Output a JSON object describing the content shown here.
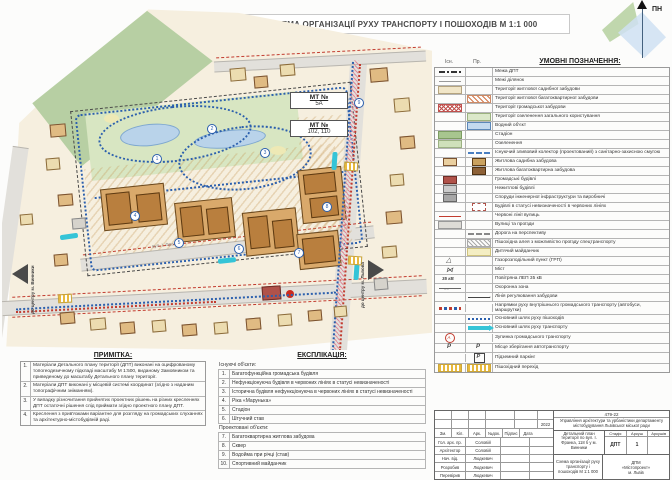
{
  "title": "СХЕМА ОРГАНІЗАЦІЇ РУХУ ТРАНСПОРТУ І ПОШОХОДІВ М 1:1 000",
  "north_label": "ПН",
  "map": {
    "mt1_title": "МТ №",
    "mt1_value": "5А",
    "mt2_title": "МТ №",
    "mt2_value": "102, 110",
    "street_label": "вул. І. Франка",
    "arrow_left_label": "до центру м. Винники",
    "arrow_right_label": "до центру м. Львова",
    "path_numbers": [
      "1",
      "2",
      "3",
      "4",
      "5",
      "6",
      "7",
      "8",
      "9"
    ]
  },
  "legend": {
    "header": "УМОВНІ ПОЗНАЧЕННЯ:",
    "col_exist": "Існ.",
    "col_proj": "Пр.",
    "rows": [
      {
        "label": "Межа ДПТ",
        "ex": "ln-dashdot"
      },
      {
        "label": "Межі ділянок",
        "ex": "ln-thin"
      },
      {
        "label": "Території житлової садибної забудови",
        "ex": "f-cream"
      },
      {
        "label": "Території житлової багатоквартирної забудови",
        "pr": "h-orange"
      },
      {
        "label": "Території громадської забудови",
        "ex": "h-red"
      },
      {
        "label": "Території озеленення загального користування",
        "pr": "h-green"
      },
      {
        "label": "Водний об'єкт",
        "pr": "f-water"
      },
      {
        "label": "Стадіон",
        "ex": "f-green"
      },
      {
        "label": "Озеленення",
        "ex": "f-green2"
      },
      {
        "label": "Існуючий зливовий колектор (проектований) з санітарно-захисною смугою",
        "pr": "ln-bluedash"
      },
      {
        "label": "Житлова садибна забудова",
        "ex": "b-tan",
        "pr": "b-tandark"
      },
      {
        "label": "Житлова багатоквартирна забудова",
        "pr": "b-brown"
      },
      {
        "label": "Громадські будівлі",
        "ex": "b-red"
      },
      {
        "label": "Нежитлові будівлі",
        "ex": "b-gray"
      },
      {
        "label": "Споруди інженерної інфраструктури та виробничі",
        "ex": "b-dgray"
      },
      {
        "label": "Будівлі в статусі невизначеності в червоних лініях",
        "pr": "b-dash"
      },
      {
        "label": "Червоні лінії вулиць",
        "ex": "ln-red"
      },
      {
        "label": "Вулиці та проїзди",
        "ex": "f-road"
      },
      {
        "label": "Дорога на перспективу",
        "pr": "ln-dashgray"
      },
      {
        "label": "Пішохідна алея з можливістю проїзду спецтранспорту",
        "pr": "h-gray"
      },
      {
        "label": "Дитячий майданчик",
        "pr": "f-yellow"
      },
      {
        "label": "Газорозподільний пункт (ГРП)",
        "ex": "g-grp"
      },
      {
        "label": "Міст",
        "ex": "g-bridge"
      },
      {
        "label": "Повітряна ЛЕП 35 кВ",
        "ex": "g-lep"
      },
      {
        "label": "Охоронна зона",
        "ex": "ln-guard"
      },
      {
        "label": "Лінія регулювання забудови",
        "pr": "ln-reg"
      },
      {
        "label": "Напрямки руху внутрішнього громадського транспорту (автобуси, маршрутки)",
        "ex": "ln-bus"
      },
      {
        "label": "Основний шлях руху пішоходів",
        "pr": "ln-bluedots"
      },
      {
        "label": "Основний шлях руху транспорту",
        "pr": "ar-cyan"
      },
      {
        "label": "Зупинка громадського транспорту",
        "ex": "g-stop"
      },
      {
        "label": "Місце зберігання автотранспорту",
        "ex": "g-park",
        "pr": "g-park"
      },
      {
        "label": "Підземний паркінг",
        "pr": "g-parkbox"
      },
      {
        "label": "Пішохідний перехід",
        "ex": "f-cross",
        "pr": "f-cross"
      }
    ]
  },
  "notes": {
    "header": "ПРИМІТКА:",
    "items": [
      {
        "num": "1.",
        "text": "Матеріали Детального плану території (ДПТ) виконані на оцифрованому топогеодезичному підкладі масштабу М 1:500, виданому Замовником та приведеному до масштабу Детального плану території."
      },
      {
        "num": "2.",
        "text": "Матеріали ДПТ виконані у місцевій системі координат (згідно з наданим топографічним зніманням)."
      },
      {
        "num": "3.",
        "text": "У випадку різночитання прийнятих проектних рішень на різних кресленнях ДПТ остаточні рішення слід приймати згідно проектного плану ДПТ."
      },
      {
        "num": "4.",
        "text": "Креслення з прив'язками варіантне для розгляду на громадських слуханнях та архітектурно-містобудівній раді."
      }
    ]
  },
  "explication": {
    "header": "ЕКСПЛІКАЦІЯ:",
    "group_existing": "Існуючі об'єкти:",
    "group_planned": "Проектовані об'єкти:",
    "items_existing": [
      {
        "num": "1.",
        "text": "Багатофункційна громадська будівля"
      },
      {
        "num": "2.",
        "text": "Нефункціонуюча будівля в червоних лініях в статусі невизначеності"
      },
      {
        "num": "3.",
        "text": "Історична будівля нефункціонуюча в червоних лініях в статусі невизначеності"
      },
      {
        "num": "4.",
        "text": "Ріка «Марунька»"
      },
      {
        "num": "5.",
        "text": "Стадіон"
      },
      {
        "num": "6.",
        "text": "Штучний став"
      }
    ],
    "items_planned": [
      {
        "num": "7.",
        "text": "Багатоквартирна житлова забудова"
      },
      {
        "num": "8.",
        "text": "Сквер"
      },
      {
        "num": "9.",
        "text": "Водойма при річці (став)"
      },
      {
        "num": "10.",
        "text": "Спортивний майданчик"
      }
    ]
  },
  "stamp": {
    "doc_no": "479-22",
    "org": "Управління архітектури та урбаністики департаменту містобудування Львівської міської ради",
    "rev_headers": [
      "Зм.",
      "Кіл.",
      "Арк.",
      "№док.",
      "Підпис",
      "Дата"
    ],
    "date_value": "2022",
    "roles": [
      {
        "role": "Гол. арх. пр.",
        "name": "Соловій"
      },
      {
        "role": "Архітектор",
        "name": "Соловій"
      },
      {
        "role": "Нач. від.",
        "name": "Людкевич"
      },
      {
        "role": "Розробив",
        "name": "Людкевич"
      },
      {
        "role": "Перевірив",
        "name": "Людкевич"
      }
    ],
    "project": "Детальний план території по вул. І. Франка, 118 б у м. Винники",
    "stage_headers": [
      "Стадія",
      "Аркуш",
      "Аркушів"
    ],
    "stage_value": "ДПТ",
    "sheet_value": "1",
    "sheets_value": "",
    "drawing": "Схема організації руху транспорту і пошоходів М 1:1 000",
    "firm_line1": "ДПМ",
    "firm_line2": "«Містопроект»",
    "firm_line3": "м. Львів"
  }
}
